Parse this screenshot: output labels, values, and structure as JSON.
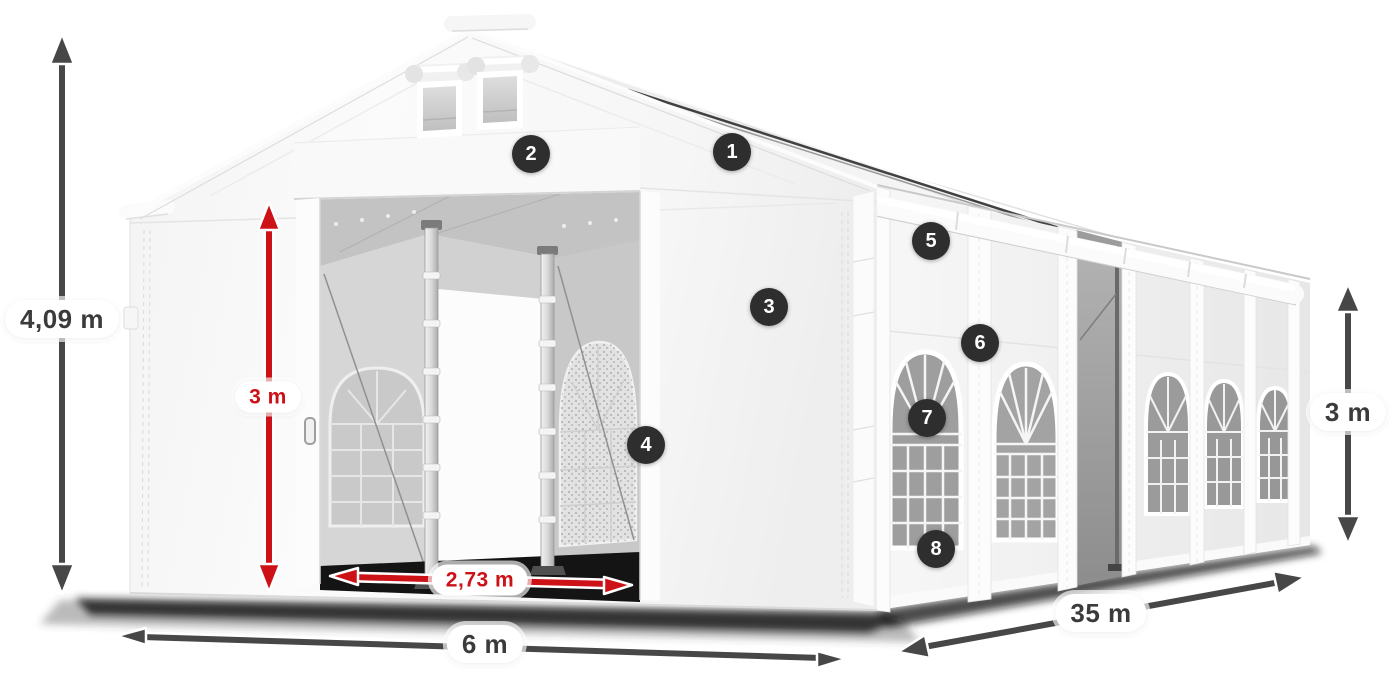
{
  "diagram": {
    "dimensions": {
      "total_height": "4,09 m",
      "entrance_height": "3 m",
      "entrance_width": "2,73 m",
      "front_width": "6 m",
      "side_length": "35 m",
      "side_height": "3 m"
    },
    "callouts": [
      "1",
      "2",
      "3",
      "4",
      "5",
      "6",
      "7",
      "8"
    ],
    "colors": {
      "dimension_arrow": "#474747",
      "highlight_arrow": "#cc1117",
      "callout_background": "#2e2e2e",
      "callout_text": "#ffffff",
      "label_background": "#ffffff",
      "label_text": "#3b3b3b"
    }
  }
}
